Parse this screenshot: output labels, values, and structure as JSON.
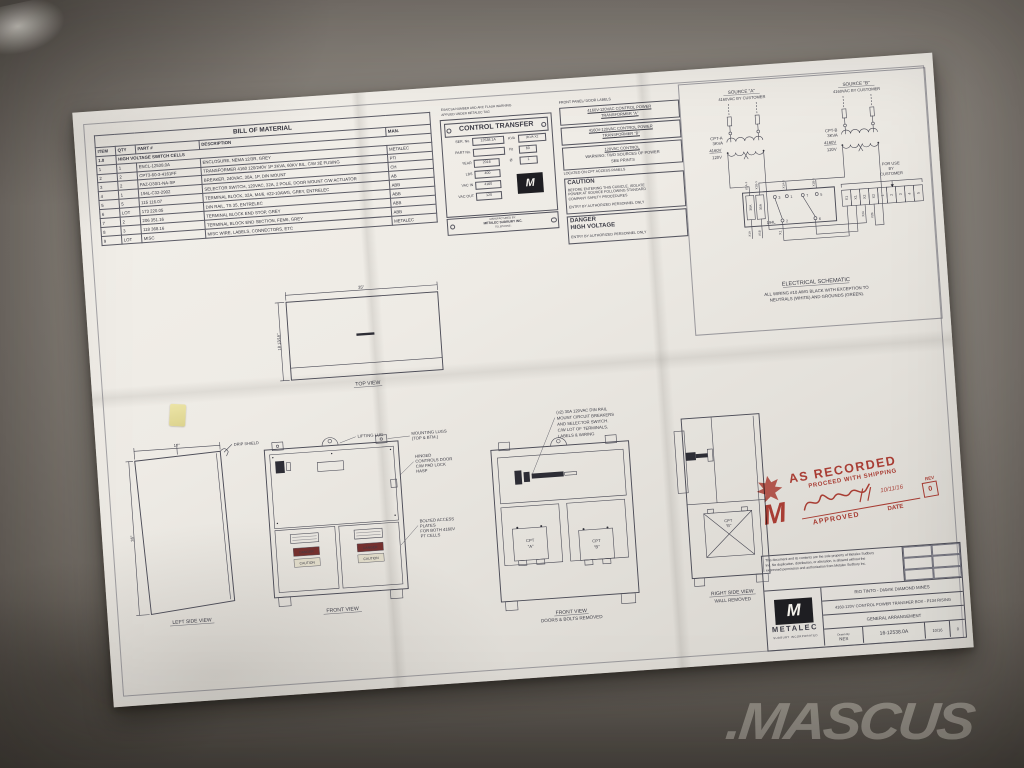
{
  "watermark": {
    "text": ".MASCUS"
  },
  "bom": {
    "title": "BILL OF MATERIAL",
    "headers": [
      "ITEM",
      "QTY",
      "PART #",
      "DESCRIPTION",
      "MAN."
    ],
    "section": {
      "num": "1.0",
      "label": "HIGH VOLTAGE SWITCH CELLS"
    },
    "rows": [
      {
        "item": "1",
        "qty": "1",
        "part": "ENCL-12538.0A",
        "desc": "ENCLOSURE, NEMA 12/3R, GREY",
        "man": "METALEC"
      },
      {
        "item": "2",
        "qty": "2",
        "part": "CPT3-60-3-4161FF",
        "desc": "TRANSFORMER 4160 120/240V 1P 3KVA, 60KV BIL, C/W 3E FUSING",
        "man": "PTI"
      },
      {
        "item": "3",
        "qty": "2",
        "part": "FAZ-D30/1-NA-SP",
        "desc": "BREAKER, 240VAC, 30A, 1P, DIN MOUNT",
        "man": "CH"
      },
      {
        "item": "4",
        "qty": "1",
        "part": "194L-C32-2902",
        "desc": "SELECTOR SWITCH, 120VAC, 32A, 2 POLE, DOOR MOUNT C/W ACTUATOR",
        "man": "AB"
      },
      {
        "item": "5",
        "qty": "5",
        "part": "115 116.07",
        "desc": "TERMINAL BLOCK, 32A, M4/6, #22-10AWG, GREY, ENTRELEC",
        "man": "ABB"
      },
      {
        "item": "6",
        "qty": "LOT",
        "part": "173 220.05",
        "desc": "DIN RAIL, TS 35, ENTRELEC",
        "man": "ABB"
      },
      {
        "item": "7",
        "qty": "2",
        "part": "206 351.16",
        "desc": "TERMINAL BLOCK END STOP, GREY",
        "man": "ABB"
      },
      {
        "item": "8",
        "qty": "3",
        "part": "118 368.16",
        "desc": "TERMINAL BLOCK END SECTION, FEM6, GREY",
        "man": "ABB"
      },
      {
        "item": "9",
        "qty": "LOT",
        "part": "MISC",
        "desc": "MISC WIRE, LABELS, CONNECTORS, ETC",
        "man": "METALEC"
      }
    ]
  },
  "nameplate": {
    "note": [
      "ESA/CSA NUMBER AND ARC FLASH WARNING",
      "APPLIED UNDER METALEC TAG"
    ],
    "title": "CONTROL TRANSFER",
    "fields": [
      {
        "label": "SER. No.",
        "value": "12538.1A"
      },
      {
        "label": "PART No.",
        "value": ""
      },
      {
        "label": "YEAR",
        "value": "2016"
      },
      {
        "label": "LBS",
        "value": "400"
      },
      {
        "label": "VAC IN",
        "value": "4160"
      },
      {
        "label": "VAC OUT",
        "value": "120"
      }
    ],
    "fields_right": [
      {
        "label": "KVA",
        "value": "3KVA X2"
      },
      {
        "label": "Hz",
        "value": "60"
      },
      {
        "label": "Ø",
        "value": "1"
      }
    ],
    "mfg_label": "MANUFACTURED BY:",
    "mfg_name": "METALEC SUDBURY INC.",
    "mfg_line2": "TELEPHONE:"
  },
  "door_labels": {
    "header": "FRONT PANEL/ DOOR LABELS",
    "label_a": [
      "4160V-120VAC CONTROL POWER",
      "TRANSFORMER \"A\""
    ],
    "label_b": [
      "4160V-120VAC CONTROL POWER",
      "TRANSFORMER \"B\""
    ],
    "label_c": [
      "120VAC CONTROL",
      "WARNING: TWO SOURCES OF POWER",
      "SEE PRINTS"
    ],
    "footer": "LOCATED ON CPT ACCESS PANELS"
  },
  "caution": {
    "title": "CAUTION",
    "lines": [
      "BEFORE ENTERING THIS CUBICLE, ISOLATE",
      "POWER AT SOURCE FOLLOWING STANDARD",
      "COMPANY SAFETY PROCEDURES"
    ],
    "entry": "ENTRY BY AUTHORIZED PERSONNEL ONLY"
  },
  "danger": {
    "title": "DANGER",
    "subtitle": "HIGH VOLTAGE",
    "entry": "ENTRY BY AUTHORIZED PERSONNEL ONLY"
  },
  "schematic": {
    "source_a": "SOURCE \"A\"",
    "source_a_sub": "4160VAC BY CUSTOMER",
    "source_b": "SOURCE \"B\"",
    "source_b_sub": "4160VAC BY CUSTOMER",
    "cpt_a": {
      "name": "CPT-A",
      "kva": "3KVA",
      "primary": "4160V",
      "secondary": "120V"
    },
    "cpt_b": {
      "name": "CPT-B",
      "kva": "3KVA",
      "primary": "4160V",
      "secondary": "120V"
    },
    "switch_label": "194L",
    "breaker": "30A",
    "contacts": [
      "3",
      "1",
      "7",
      "5",
      "2",
      "6"
    ],
    "top_wires": [
      "X1A-1",
      "X1B-1",
      "X1A-1",
      "X1B-1"
    ],
    "bottom_wires": [
      "X1A",
      "X1B",
      "X1",
      "X2A",
      "X2B"
    ],
    "terminals": [
      "X1",
      "X1",
      "X2",
      "X2",
      "1",
      "2",
      "3",
      "4",
      "5"
    ],
    "for_use": [
      "FOR USE",
      "BY",
      "CUSTOMER"
    ],
    "caption": "ELECTRICAL SCHEMATIC",
    "note": [
      "ALL WIRING #10 AWG BLACK WITH EXCEPTION TO",
      "NEUTRALS (WHITE) AND GROUNDS (GREEN)."
    ]
  },
  "views": {
    "top": {
      "caption": "TOP VIEW",
      "width": "35\"",
      "depth": "18 13/16\""
    },
    "left": {
      "caption": "LEFT SIDE VIEW",
      "width": "17\"",
      "height": "36\"",
      "drip": "DRIP SHIELD"
    },
    "front": {
      "caption": "FRONT VIEW",
      "callout_lift": "LIFTING LUG",
      "callout_mount": [
        "MOUNTING LUGS",
        "(TOP & BTM.)"
      ],
      "callout_hinge": [
        "HINGED",
        "CONTROLS DOOR",
        "C/W PAD LOCK",
        "HASP"
      ],
      "callout_bolted": [
        "BOLTED ACCESS",
        "PLATES",
        "FOR BOTH 4160V",
        "PT CELLS"
      ],
      "mini_danger": "DANGER",
      "mini_caution": "CAUTION"
    },
    "front_open": {
      "caption": "FRONT VIEW",
      "caption2": "DOORS & BOLTS REMOVED",
      "annotation": [
        "(x2) 30A 120VAC DIN RAIL",
        "MOUNT CIRCUIT BREAKERS",
        "AND SELECTOR SWITCH.",
        "C/W LOT OF TERMINALS,",
        "LABELS & WIRING"
      ],
      "cpt_a": [
        "CPT",
        "\"A\""
      ],
      "cpt_b": [
        "CPT",
        "\"B\""
      ]
    },
    "right": {
      "caption": "RIGHT SIDE VIEW",
      "caption2": "WALL REMOVED",
      "cpt_b": [
        "CPT",
        "\"B\""
      ]
    }
  },
  "stamp": {
    "line1": "AS RECORDED",
    "line2": "PROCEED WITH SHIPPING",
    "approved": "APPROVED",
    "date_label": "DATE",
    "signature_date": "10/11/16",
    "rev_label": "REV",
    "rev": "0"
  },
  "titleblock": {
    "disclaimer": [
      "This document and its contents are the sole property of Metalec Sudbury",
      "Inc.  No duplication, distribution, or alteration, is allowed without the",
      "expressed permission and authorization from Metalec Sudbury Inc."
    ],
    "company": "METALEC",
    "company_sub": "SUDBURY INCORPORATED",
    "project": "RIO TINTO - DIAVIK DIAMOND MINES",
    "title2": "4160-120V CONTROL POWER TRANSFER BOX - P134 RISING",
    "title3": "GENERAL ARRANGEMENT",
    "drawn_label": "Drawn By",
    "drawn": "NES",
    "number": "16-12538.0A",
    "date": "10/16",
    "rev": "0"
  }
}
